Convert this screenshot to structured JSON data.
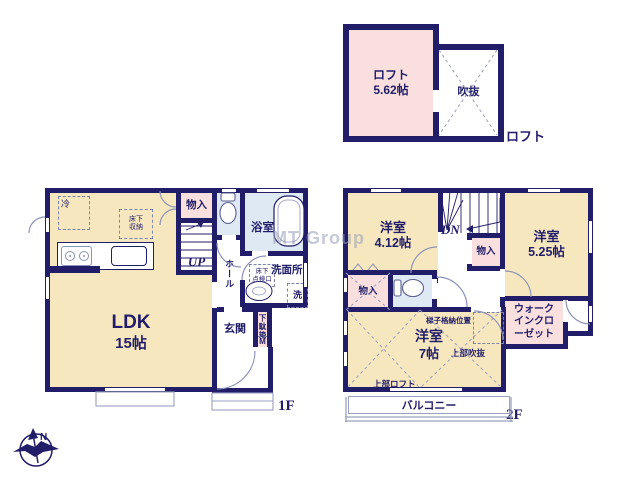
{
  "palette": {
    "wall": "#211d69",
    "cream": "#f7e7bf",
    "pink": "#fadfdf",
    "blue": "#dfe9f4",
    "line": "#8d93b8",
    "ink": "#211d69",
    "dash": "#7b82ad",
    "faint": "#9aa0bf"
  },
  "watermark": "MT Group",
  "compass": {
    "north": "N"
  },
  "loft": {
    "room_label": "ロフト",
    "room_size": "5.62帖",
    "void_label": "吹抜",
    "floor_label": "ロフト"
  },
  "f1": {
    "floor_label": "1F",
    "ldk_label": "LDK",
    "ldk_size": "15帖",
    "fridge": "冷",
    "underfloor_storage": "床下\n収納",
    "closet": "物入",
    "stairs_up": "UP",
    "bath": "浴室",
    "washroom": "洗面所",
    "underfloor_hatch": "床下\n点検口",
    "washer": "洗",
    "hall": "ホール",
    "entrance": "玄関",
    "shoebox": "下駄箱",
    "meter": "M"
  },
  "f2": {
    "floor_label": "2F",
    "room412_label": "洋室",
    "room412_size": "4.12帖",
    "stairs_down": "DN",
    "closet_a": "物入",
    "room525_label": "洋室",
    "room525_size": "5.25帖",
    "closet_b": "物入",
    "room7_label": "洋室",
    "room7_size": "7帖",
    "ladder_note": "梯子格納位置",
    "upper_void": "上部吹抜",
    "upper_loft": "上部ロフト",
    "wic": "ウォークインクローゼット",
    "balcony": "バルコニー"
  }
}
